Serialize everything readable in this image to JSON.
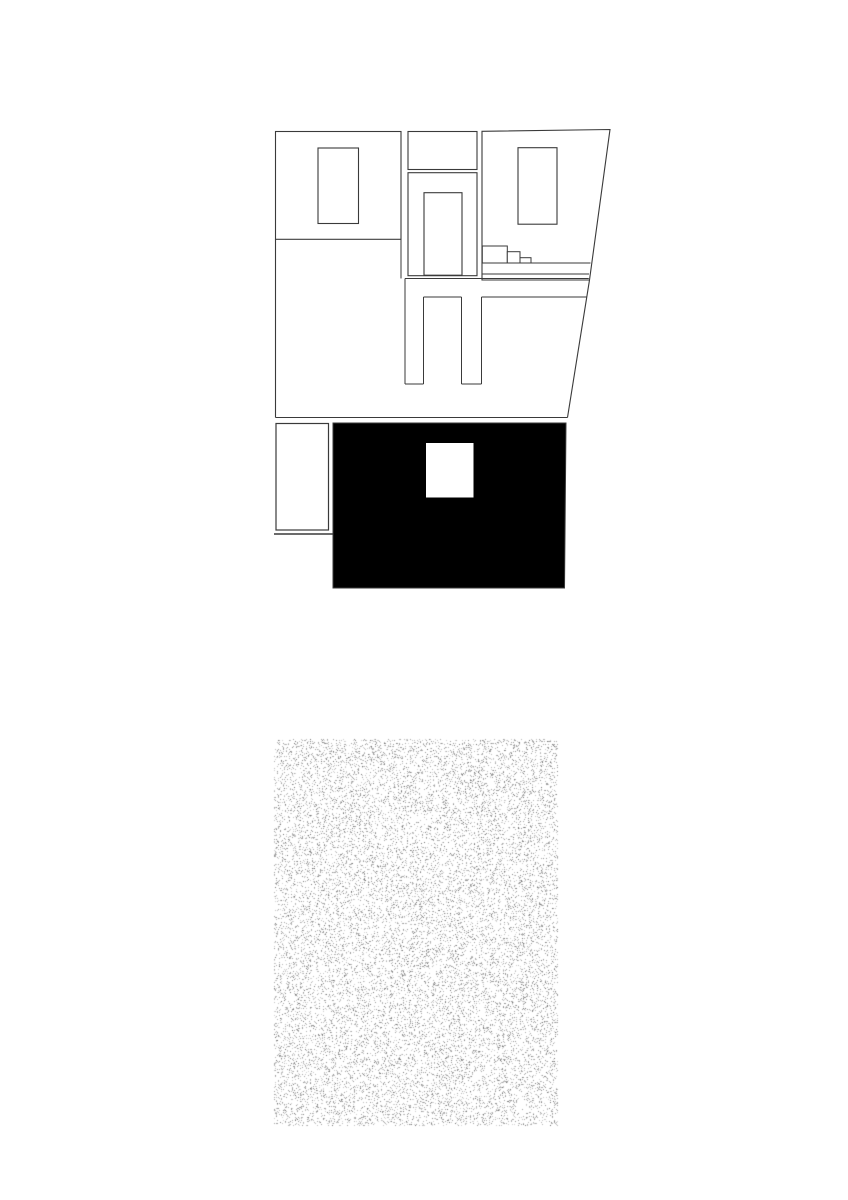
{
  "canvas": {
    "width": 848,
    "height": 1200
  },
  "colors": {
    "line": "#3a3a3a",
    "black": "#000000",
    "white": "#ffffff",
    "palm": "#262626",
    "stipple_light_min": 150,
    "stipple_light_max": 215,
    "stipple_dark_min": 110,
    "stipple_dark_max": 155
  },
  "ground": {
    "x": 274,
    "y": 739,
    "w": 284,
    "h": 387,
    "density": 0.16,
    "dark_density": 0.018,
    "seed": 1337
  },
  "layers": [
    {
      "name": "upper-elevation",
      "type": "shapes",
      "ops": [
        {
          "t": "rect",
          "x": 275.5,
          "y": 131.5,
          "w": 125.5,
          "h": 107.8,
          "f": "white",
          "s": "line",
          "sw": 1.1
        },
        {
          "t": "rect",
          "x": 318,
          "y": 148,
          "w": 40.5,
          "h": 75.5,
          "f": "white",
          "s": "line",
          "sw": 1.1
        },
        {
          "t": "rect",
          "x": 408,
          "y": 131.5,
          "w": 69,
          "h": 38,
          "f": "white",
          "s": "line",
          "sw": 1.1
        },
        {
          "t": "rect",
          "x": 408,
          "y": 172.7,
          "w": 69,
          "h": 103,
          "f": "white",
          "s": "line",
          "sw": 1.1
        },
        {
          "t": "rect",
          "x": 424,
          "y": 192.7,
          "w": 38,
          "h": 82.5,
          "f": "white",
          "s": "line",
          "sw": 1.1
        },
        {
          "t": "poly",
          "pts": [
            [
              482,
              131.3
            ],
            [
              610,
              129.5
            ],
            [
              589.5,
              280
            ],
            [
              482,
              280
            ]
          ],
          "f": "white",
          "s": "line",
          "sw": 1.1
        },
        {
          "t": "rect",
          "x": 518,
          "y": 147.7,
          "w": 39,
          "h": 76.5,
          "f": "white",
          "s": "line",
          "sw": 1.1
        },
        {
          "t": "rect",
          "x": 482.3,
          "y": 246,
          "w": 25,
          "h": 17,
          "f": "white",
          "s": "line",
          "sw": 1
        },
        {
          "t": "rect",
          "x": 507.3,
          "y": 251.7,
          "w": 12.7,
          "h": 11.3,
          "f": "white",
          "s": "line",
          "sw": 1
        },
        {
          "t": "rect",
          "x": 520,
          "y": 257.7,
          "w": 11,
          "h": 5.3,
          "f": "white",
          "s": "line",
          "sw": 1
        },
        {
          "t": "line",
          "x1": 482,
          "y1": 263,
          "x2": 590.5,
          "y2": 263,
          "s": "line",
          "sw": 1
        },
        {
          "t": "line",
          "x1": 482,
          "y1": 274,
          "x2": 589,
          "y2": 274,
          "s": "line",
          "sw": 1
        },
        {
          "t": "line",
          "x1": 275.5,
          "y1": 239.3,
          "x2": 275.5,
          "y2": 417.5,
          "s": "line",
          "sw": 1.1
        },
        {
          "t": "line",
          "x1": 401,
          "y1": 239.3,
          "x2": 401,
          "y2": 278.5,
          "s": "line",
          "sw": 1
        },
        {
          "t": "line",
          "x1": 405,
          "y1": 278.5,
          "x2": 588.8,
          "y2": 278.5,
          "s": "line",
          "sw": 1
        },
        {
          "t": "line",
          "x1": 405,
          "y1": 278.5,
          "x2": 405,
          "y2": 384,
          "s": "line",
          "sw": 1
        },
        {
          "t": "line",
          "x1": 405,
          "y1": 384,
          "x2": 423.5,
          "y2": 384,
          "s": "line",
          "sw": 1
        },
        {
          "t": "line",
          "x1": 423.5,
          "y1": 297,
          "x2": 423.5,
          "y2": 384,
          "s": "line",
          "sw": 1
        },
        {
          "t": "line",
          "x1": 423.5,
          "y1": 297,
          "x2": 461.5,
          "y2": 297,
          "s": "line",
          "sw": 1
        },
        {
          "t": "line",
          "x1": 461.5,
          "y1": 297,
          "x2": 461.5,
          "y2": 384,
          "s": "line",
          "sw": 1
        },
        {
          "t": "line",
          "x1": 461.5,
          "y1": 384,
          "x2": 481.5,
          "y2": 384,
          "s": "line",
          "sw": 1
        },
        {
          "t": "line",
          "x1": 481.5,
          "y1": 297,
          "x2": 481.5,
          "y2": 384,
          "s": "line",
          "sw": 1
        },
        {
          "t": "line",
          "x1": 481.5,
          "y1": 297,
          "x2": 586.5,
          "y2": 297,
          "s": "line",
          "sw": 1
        },
        {
          "t": "line",
          "x1": 275.5,
          "y1": 417.5,
          "x2": 567.5,
          "y2": 417.5,
          "s": "line",
          "sw": 1.1
        },
        {
          "t": "line",
          "x1": 589.5,
          "y1": 280,
          "x2": 567.5,
          "y2": 417.5,
          "s": "line",
          "sw": 1.1
        }
      ]
    },
    {
      "name": "section-plan",
      "type": "shapes",
      "ops": [
        {
          "t": "poly",
          "pts": [
            [
              333,
              423
            ],
            [
              566,
              423
            ],
            [
              564.5,
              588
            ],
            [
              333,
              588
            ]
          ],
          "f": "black",
          "s": "line",
          "sw": 1
        },
        {
          "t": "rect",
          "x": 276,
          "y": 423.5,
          "w": 52.5,
          "h": 106.5,
          "f": "white",
          "s": "line",
          "sw": 1.2
        },
        {
          "t": "line",
          "x1": 274,
          "y1": 534,
          "x2": 332.5,
          "y2": 534,
          "s": "line",
          "sw": 1.5
        },
        {
          "t": "rect",
          "x": 426,
          "y": 443,
          "w": 47.5,
          "h": 54.5,
          "f": "white"
        },
        {
          "t": "path",
          "d": "M423,497.5 A33 23 0 0 1 455.5,520.5 L473.5,520.5 L473.5,497.5 L426,497.5 Z",
          "f": "white"
        },
        {
          "t": "path",
          "d": "M423,497.5 A33 23 0 0 1 455.5,520.5",
          "s": "line",
          "sw": 1
        },
        {
          "t": "rect",
          "x": 455.5,
          "y": 520,
          "w": 18,
          "h": 68,
          "f": "white",
          "s": "line",
          "sw": 0.7
        },
        {
          "t": "rect",
          "x": 333,
          "y": 543,
          "w": 55,
          "h": 43,
          "f": "white",
          "s": "line",
          "sw": 0.9
        },
        {
          "t": "line",
          "x1": 333,
          "y1": 592.3,
          "x2": 385.5,
          "y2": 592.3,
          "s": "line",
          "sw": 1
        },
        {
          "t": "line",
          "x1": 385.5,
          "y1": 586,
          "x2": 385.5,
          "y2": 592.3,
          "s": "line",
          "sw": 1
        },
        {
          "t": "line",
          "x1": 457.7,
          "y1": 595,
          "x2": 567,
          "y2": 595,
          "s": "line",
          "sw": 1
        },
        {
          "t": "line",
          "x1": 474,
          "y1": 471,
          "x2": 560.5,
          "y2": 471,
          "s": "white",
          "sw": 2.4
        },
        {
          "t": "line",
          "x1": 475,
          "y1": 503.3,
          "x2": 558.3,
          "y2": 497.7,
          "s": "white",
          "sw": 2
        },
        {
          "t": "line",
          "x1": 334,
          "y1": 496.5,
          "x2": 423.5,
          "y2": 496.5,
          "s": "white",
          "sw": 1.8
        },
        {
          "t": "line",
          "x1": 333,
          "y1": 510,
          "x2": 425.5,
          "y2": 510,
          "s": "white",
          "sw": 1.8
        },
        {
          "t": "line",
          "x1": 388.5,
          "y1": 496.5,
          "x2": 388.5,
          "y2": 543,
          "s": "white",
          "sw": 1.8
        },
        {
          "t": "line",
          "x1": 360.5,
          "y1": 510,
          "x2": 360.5,
          "y2": 543,
          "s": "white",
          "sw": 1.8
        },
        {
          "t": "line",
          "x1": 333,
          "y1": 517.5,
          "x2": 360.5,
          "y2": 517.5,
          "s": "white",
          "sw": 1.8
        },
        {
          "t": "line",
          "x1": 333,
          "y1": 526,
          "x2": 360.5,
          "y2": 526,
          "s": "white",
          "sw": 1.8
        },
        {
          "t": "line",
          "x1": 333,
          "y1": 534.5,
          "x2": 360.5,
          "y2": 534.5,
          "s": "white",
          "sw": 1.8
        },
        {
          "t": "line",
          "x1": 388.5,
          "y1": 530,
          "x2": 425.5,
          "y2": 530,
          "s": "white",
          "sw": 1.8
        },
        {
          "t": "poly",
          "pts": [
            [
              476,
              529
            ],
            [
              558.5,
              523.5
            ],
            [
              558.5,
              535.5
            ],
            [
              476,
              541
            ]
          ],
          "f": "white"
        },
        {
          "t": "rect",
          "x": 513,
          "y": 541.7,
          "w": 48.5,
          "h": 14.8,
          "f": "white",
          "s": "line",
          "sw": 1
        },
        {
          "t": "rect",
          "x": 517,
          "y": 545,
          "w": 41,
          "h": 9.3,
          "s": "line",
          "sw": 0.9
        },
        {
          "t": "line",
          "x1": 474,
          "y1": 558,
          "x2": 564,
          "y2": 558,
          "s": "white",
          "sw": 2.4
        },
        {
          "t": "line",
          "x1": 559.5,
          "y1": 466.5,
          "x2": 566.5,
          "y2": 457.5,
          "s": "white",
          "sw": 2
        },
        {
          "t": "poly",
          "pts": [
            [
              468.3,
              515
            ],
            [
              488.3,
              513
            ],
            [
              491,
              538.5
            ],
            [
              467.7,
              540
            ]
          ],
          "f": "white",
          "s": "line",
          "sw": 1
        },
        {
          "t": "line",
          "x1": 470.3,
          "y1": 516.5,
          "x2": 473.2,
          "y2": 539,
          "s": "line",
          "sw": 1
        },
        {
          "t": "poly",
          "pts": [
            [
              469.3,
              540
            ],
            [
              472.8,
              540
            ],
            [
              471.8,
              571
            ],
            [
              470,
              571
            ]
          ],
          "f": "white",
          "s": "line",
          "sw": 0.7
        },
        {
          "t": "line",
          "x1": 388,
          "y1": 543,
          "x2": 388,
          "y2": 592,
          "s": "line",
          "sw": 1,
          "d": [
            2.2,
            2.4
          ]
        },
        {
          "t": "line",
          "x1": 456.5,
          "y1": 520.5,
          "x2": 456.5,
          "y2": 588,
          "s": "line",
          "sw": 1,
          "d": [
            2.2,
            2.4
          ]
        }
      ]
    },
    {
      "name": "entry-platform",
      "type": "shapes",
      "ops": [
        {
          "t": "rect",
          "x": 332.5,
          "y": 598.3,
          "w": 226,
          "h": 44.4,
          "f": "white",
          "s": "line",
          "sw": 1.2
        }
      ]
    },
    {
      "name": "exterior-stairs",
      "type": "stairs",
      "x": 395.5,
      "y": 642.7,
      "w": 53.3,
      "h": 124,
      "treads": 13,
      "sw": 1
    },
    {
      "name": "palm-tree",
      "type": "palm",
      "fronds": [
        {
          "s": [
            297,
            865
          ],
          "c": [
            258,
            872
          ],
          "e": [
            246,
            910
          ],
          "tick": 6
        },
        {
          "s": [
            296,
            863
          ],
          "c": [
            266,
            858
          ],
          "e": [
            249,
            880
          ],
          "tick": 6
        },
        {
          "s": [
            298,
            860
          ],
          "c": [
            280,
            849
          ],
          "e": [
            262,
            852
          ],
          "tick": 5
        },
        {
          "s": [
            302,
            858
          ],
          "c": [
            302,
            848
          ],
          "e": [
            303,
            845
          ],
          "tick": 6.5
        },
        {
          "s": [
            306,
            860
          ],
          "c": [
            323,
            848
          ],
          "e": [
            344,
            853
          ],
          "tick": 5.5
        },
        {
          "s": [
            308,
            863
          ],
          "c": [
            334,
            858
          ],
          "e": [
            361,
            872
          ],
          "tick": 6
        },
        {
          "s": [
            309,
            867
          ],
          "c": [
            333,
            872
          ],
          "e": [
            352,
            892
          ],
          "tick": 6
        },
        {
          "s": [
            307,
            872
          ],
          "c": [
            337,
            885
          ],
          "e": [
            347,
            920
          ],
          "tick": 7
        },
        {
          "s": [
            302,
            871
          ],
          "c": [
            312,
            893
          ],
          "e": [
            317,
            928
          ],
          "tick": 7.5
        },
        {
          "s": [
            297,
            871
          ],
          "c": [
            287,
            893
          ],
          "e": [
            282,
            924
          ],
          "tick": 7.5
        },
        {
          "s": [
            294,
            867
          ],
          "c": [
            272,
            875
          ],
          "e": [
            257,
            899
          ],
          "tick": 6.5
        }
      ],
      "tick_spacing": 2.7,
      "tips": [
        [
          282,
          925.5
        ],
        [
          345,
          922.5
        ]
      ],
      "trunk": {
        "left": "M303.5,932 C301.5,985 299,1040 298,1095",
        "right": "M307.5,932 C305.5,985 303.2,1040 302.6,1096",
        "fill": "M303.5,932 C301.5,985 299,1040 298,1095 L302.6,1096 C303.2,1040 305.5,985 307.5,932 Z",
        "rung_top": 935,
        "rung_bottom": 1006,
        "rung_step": 3.3,
        "x_left_top": 303.5,
        "x_left_bottom": 298,
        "x_right_top": 307.5,
        "x_right_bottom": 302.6,
        "y_top": 932,
        "y_bottom": 1095,
        "base_marks": [
          "M296,1091.5 C296.8,1096 298,1098.5 300,1099",
          "M302.6,1096 L303.6,1099.5"
        ]
      }
    }
  ]
}
